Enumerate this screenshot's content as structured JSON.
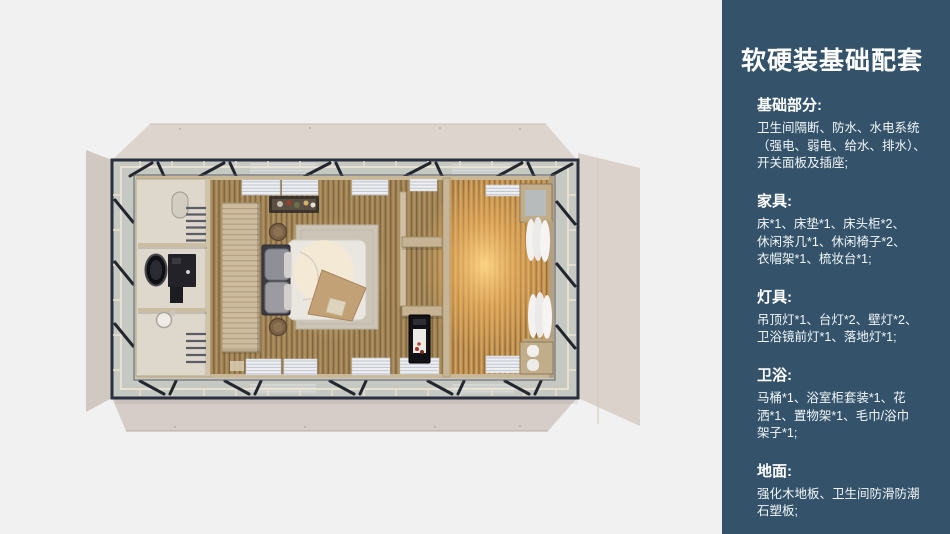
{
  "page": {
    "background": "#f1f1f2"
  },
  "colors": {
    "sidebar_bg": "#34536a",
    "sidebar_text": "#ffffff",
    "shell_beige": "#dbd2cb",
    "deck_grey": "#c6c9c2",
    "frame_dark": "#2a3040",
    "wood_floor": "#a18455",
    "wood_floor_warm": "#c39354",
    "bed_duvet": "#eae6e0",
    "lamp_glow": "#f0b35f"
  },
  "sidebar": {
    "title": "软硬装基础配套",
    "sections": [
      {
        "heading": "基础部分:",
        "lines": [
          "卫生间隔断、防水、水电系统",
          "（强电、弱电、给水、排水）、",
          "开关面板及插座;"
        ]
      },
      {
        "heading": "家具:",
        "lines": [
          "床*1、床垫*1、床头柜*2、",
          "休闲茶几*1、休闲椅子*2、",
          "衣帽架*1、梳妆台*1;"
        ]
      },
      {
        "heading": "灯具:",
        "lines": [
          "吊顶灯*1、台灯*2、壁灯*2、",
          "卫浴镜前灯*1、落地灯*1;"
        ]
      },
      {
        "heading": "卫浴:",
        "lines": [
          "马桶*1、浴室柜套装*1、花",
          "洒*1、置物架*1、毛巾/浴巾",
          "架子*1;"
        ]
      },
      {
        "heading": "地面:",
        "lines": [
          "强化木地板、卫生间防滑防潮",
          "石塑板;"
        ]
      }
    ]
  },
  "floorplan": {
    "view": "top-down-render",
    "elements": [
      "cabin-shell",
      "folding-panels",
      "deck-walkway",
      "railing",
      "bathroom",
      "shower",
      "towel-rack",
      "vanity",
      "mirror",
      "toilet",
      "wardrobe",
      "hanging-shelf",
      "nightstand",
      "double-bed",
      "headboard",
      "pillows",
      "duvet",
      "throw-blanket",
      "area-rug",
      "storage-shelves",
      "minibar-cabinet",
      "partition-wall",
      "window-blinds",
      "curtains",
      "bench",
      "floor-lamp-glow"
    ]
  }
}
